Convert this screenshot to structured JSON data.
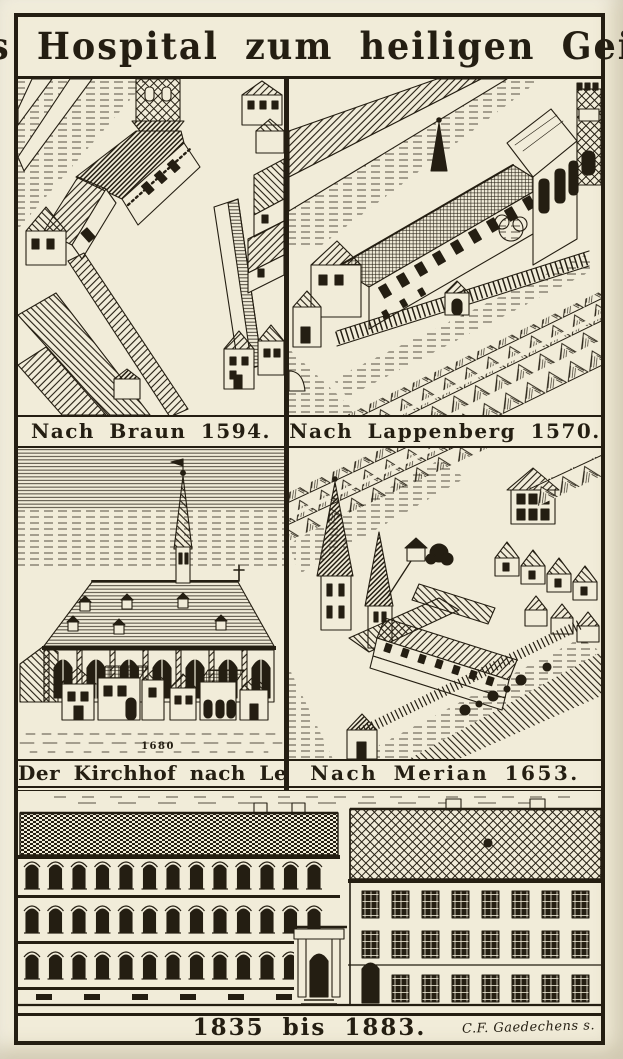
{
  "document": {
    "title": "Das Hospital zum heiligen Geist.",
    "paper_color": "#f1ecd9",
    "ink_color": "#241e12"
  },
  "panels": {
    "braun": {
      "caption": "Nach Braun 1594."
    },
    "lappenberg": {
      "caption": "Nach Lappenberg 1570."
    },
    "lemkus": {
      "caption": "Der Kirchhof nach Lemkus.",
      "inscription": "1680"
    },
    "merian": {
      "caption": "Nach Merian 1653."
    },
    "modern_building": {
      "caption": "1835 bis 1883.",
      "signature": "C.F. Gaedechens s."
    }
  }
}
